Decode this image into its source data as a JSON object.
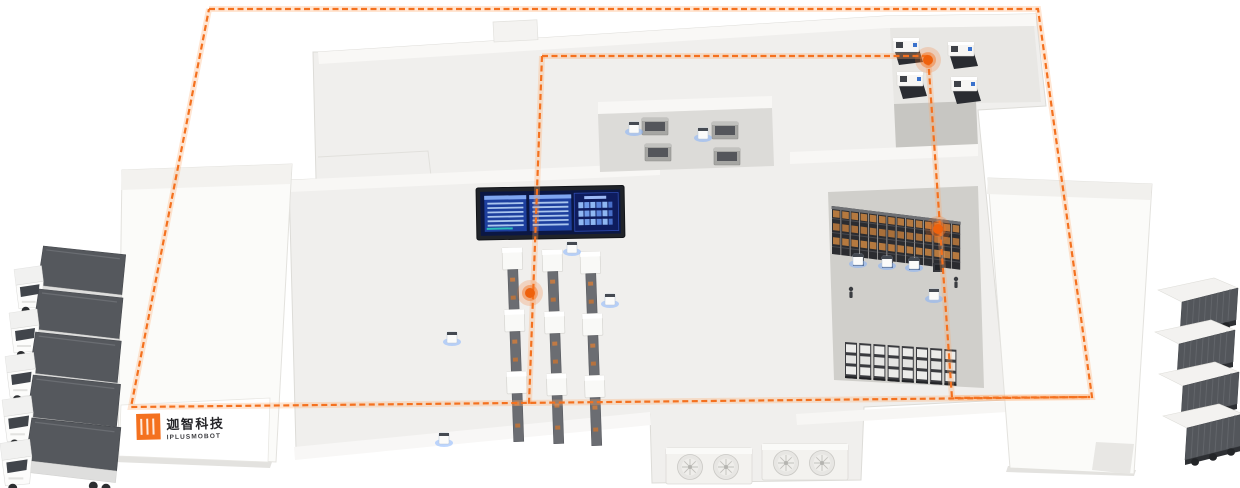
{
  "brand": {
    "logo_cn": "迦智科技",
    "logo_en": "IPLUSMOBOT",
    "accent_color": "#f4711f"
  },
  "palette": {
    "route_orange": "#f4711f",
    "route_glow": "#ffa96b",
    "agv_glow_blue": "#7db0ff",
    "building_light": "#f0efed",
    "rack_zone_gray": "#d0cfcb",
    "rack_box_orange": "#b5793f",
    "screen_panel_blue": "#1d3f9e",
    "screen_bg_blue": "#0b1744",
    "truck_cargo_gray": "#55585d"
  },
  "counts": {
    "trucks_left": 5,
    "trucks_right": 4,
    "assembly_lines": 3,
    "cnc_machines": 4,
    "buffer_machines": 4,
    "agv_robots": 10,
    "agv_docks": 4,
    "storage_rack_rows": 2,
    "hvac_units": 2,
    "route_waypoints": 3,
    "workers": 2
  },
  "route": {
    "outer_loop": "209,9 1038,9 1092,397 131,407 209,9",
    "inner_loop": "542,56 928,56 952,398 1090,397",
    "center_line": "542,56 529,404",
    "waypoints": [
      {
        "transform": "translate(928,60)"
      },
      {
        "transform": "translate(938,229)"
      },
      {
        "transform": "translate(530,293)"
      }
    ]
  },
  "spawns": [
    {
      "target": "#layer-trucks-left",
      "use": "#def-truck-left",
      "name": "truck-left",
      "positions": [
        "translate(14,246) scale(0.98)",
        "translate(9,289)",
        "translate(5,332) scale(1.02)",
        "translate(2,375) scale(1.04)",
        "translate(0,418) scale(1.06)"
      ]
    },
    {
      "target": "#layer-trucks-right",
      "use": "#def-truck-right",
      "name": "truck-right",
      "positions": [
        "translate(1152,278)",
        "translate(1149,320)",
        "translate(1153,362)",
        "translate(1157,404)"
      ]
    },
    {
      "target": "#layer-lines",
      "use": "#def-assembly-line",
      "name": "assembly-line",
      "positions": [
        "translate(502,248) rotate(-2)",
        "translate(542,250) rotate(-2)",
        "translate(580,252) rotate(-2)"
      ]
    },
    {
      "target": "#layer-cnc",
      "use": "#def-cnc-machine",
      "name": "cnc-machine",
      "positions": [
        "translate(893,38)",
        "translate(948,42)",
        "translate(897,72)",
        "translate(951,77)"
      ]
    },
    {
      "target": "#layer-cabinets",
      "use": "#def-cabinet",
      "name": "buffer-machine",
      "positions": [
        "translate(642,118)",
        "translate(712,122)",
        "translate(645,144)",
        "translate(714,148)"
      ]
    },
    {
      "target": "#layer-docks",
      "use": "#def-agv-dock",
      "name": "agv-dock",
      "positions": [
        "translate(853,257)",
        "translate(882,259)",
        "translate(909,261)",
        "translate(933,263)"
      ]
    },
    {
      "target": "#layer-agvs",
      "use": "#def-agv",
      "name": "agv-robot",
      "positions": [
        "translate(452,340)",
        "translate(444,441)",
        "translate(572,250)",
        "translate(610,302)",
        "translate(634,130)",
        "translate(703,136)",
        "translate(858,262)",
        "translate(887,264)",
        "translate(914,266)",
        "translate(934,297)"
      ]
    },
    {
      "target": "#layer-persons",
      "use": "#def-person",
      "name": "worker",
      "positions": [
        "translate(851,289)",
        "translate(956,279)"
      ]
    },
    {
      "target": "#rack1-bays",
      "use": "#def-bay-orange",
      "name": "rack-bay",
      "count": 14,
      "dx": 9.2,
      "dy": 0
    },
    {
      "target": "#rack2-units",
      "use": "#def-rack-unit",
      "name": "rack-unit",
      "count": 8,
      "dx": 14.2,
      "dy": 0
    },
    {
      "target": "#layer-hvac",
      "use": "#def-hvac",
      "name": "hvac-unit",
      "positions": [
        "translate(666,448)",
        "translate(762,444)"
      ]
    },
    {
      "target": "#dash-rows-left",
      "use": "#def-dash-row",
      "name": "dashboard-row",
      "count": 6,
      "dx": 0,
      "dy": 4.4
    },
    {
      "target": "#dash-rows-mid",
      "use": "#def-dash-row",
      "name": "dashboard-row",
      "count": 6,
      "dx": 0,
      "dy": 4.4
    },
    {
      "target": "#dash-digit-rows",
      "use": "#def-digit-row",
      "name": "dashboard-digit-row",
      "count": 3,
      "dx": 0,
      "dy": 8.5
    }
  ]
}
